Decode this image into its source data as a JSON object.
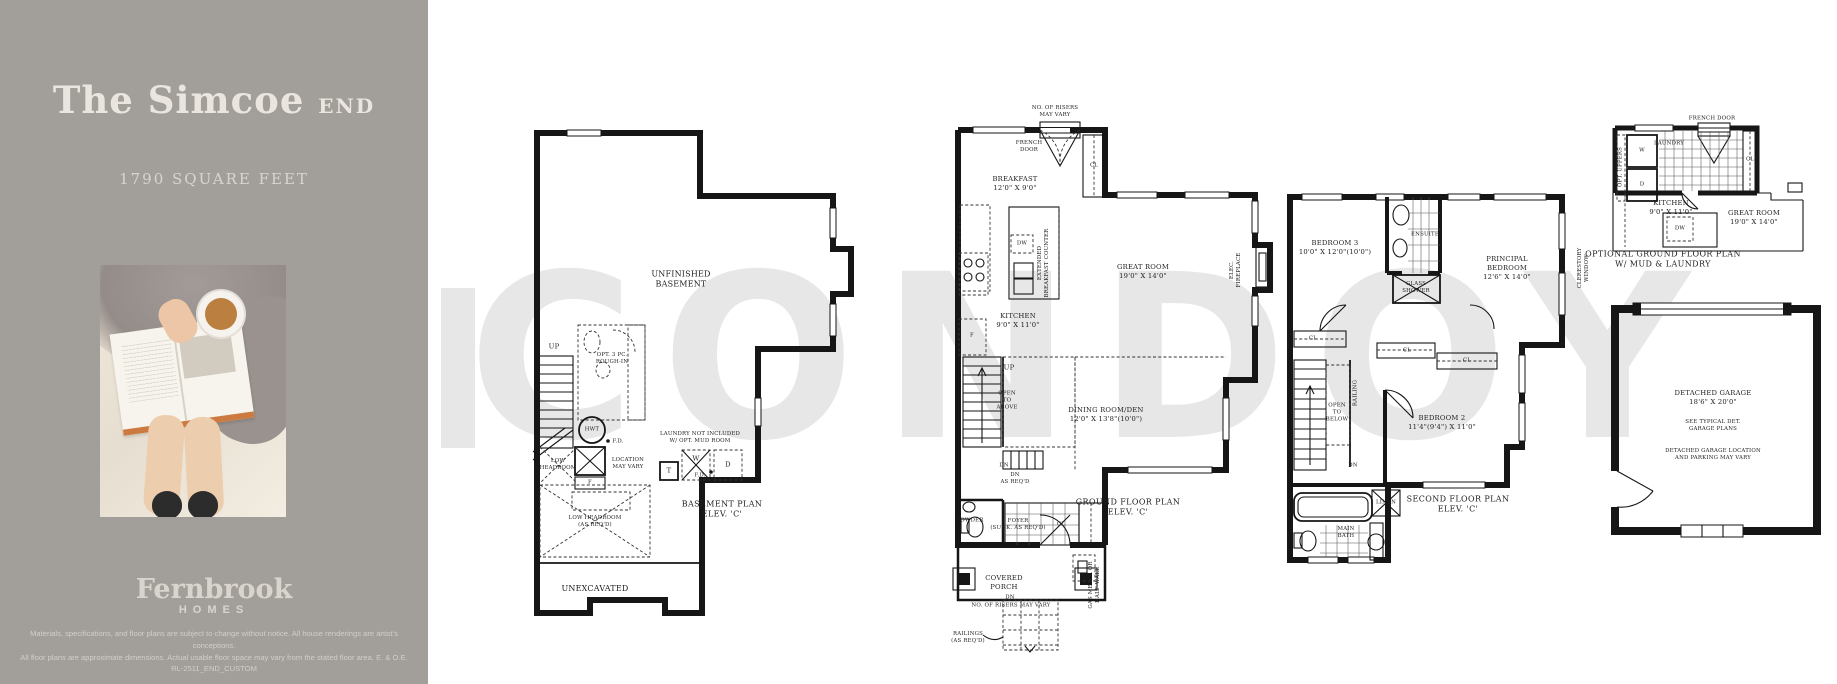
{
  "colors": {
    "sidebar_bg": "#a29e99",
    "sidebar_text": "#eae6df",
    "plan_line": "#161616",
    "watermark": "#e7e7e7"
  },
  "sidebar": {
    "title": "The Simcoe",
    "title_suffix": "END",
    "square_feet": "1790 SQUARE FEET",
    "logo_name": "Fernbrook",
    "logo_sub": "HOMES",
    "disclaimer_line1": "Materials, specifications, and floor plans are subject to change without notice. All house renderings are artist's conceptions.",
    "disclaimer_line2": "All floor plans are approximate dimensions. Actual usable floor space may vary from the stated floor area. E. & O.E. RL-2511_END_CUSTOM"
  },
  "watermark": "CONDOY",
  "basement": {
    "room": "UNFINISHED\nBASEMENT",
    "up": "UP",
    "opt_bath": "OPT. 3 PC.\nROUGH-IN",
    "hwt": "HWT",
    "fd1": "F.D.",
    "low_headroom": "LOW\nHEADROOM",
    "location": "LOCATION\nMAY VARY",
    "laundry_note": "LAUNDRY NOT INCLUDED\nW/ OPT. MUD ROOM",
    "tub": "T",
    "washer": "W",
    "dryer": "D",
    "fd2": "F.D.",
    "furnace": "F",
    "low_headroom2": "LOW HEADROOM\n(AS REQ'D)",
    "caption": "BASEMENT PLAN\nELEV. 'C'",
    "unexcavated": "UNEXCAVATED"
  },
  "ground": {
    "risers_top": "NO. OF RISERS\nMAY VARY",
    "french_door": "FRENCH\nDOOR",
    "breakfast": "BREAKFAST\n12'0\" X 9'0\"",
    "cl_top": "CL",
    "dw": "DW",
    "extended_counter": "EXTENDED\nBREAKFAST COUNTER",
    "great_room": "GREAT ROOM\n19'0\" X 14'0\"",
    "fireplace": "ELEC. FIREPLACE",
    "kitchen": "KITCHEN\n9'0\" X 11'0\"",
    "fridge": "F",
    "up": "UP",
    "open_above": "OPEN\nTO\nABOVE",
    "dining": "DINING ROOM/DEN\n12'0\" X 13'8\"(10'0\")",
    "dn": "DN",
    "dn_req": "DN\nAS REQ'D",
    "powder": "POWDER",
    "foyer": "FOYER\n(SUNK. AS REQ'D)",
    "cl_foyer": "CL",
    "caption": "GROUND FLOOR PLAN\nELEV. 'C'",
    "porch": "COVERED\nPORCH",
    "dn_porch": "DN",
    "risers_bottom": "NO. OF RISERS MAY VARY",
    "railings": "RAILINGS\n(AS REQ'D)",
    "gas_meter": "GAS METER OR\nHALF WALL"
  },
  "second": {
    "bedroom3": "BEDROOM 3\n10'0\" X 12'0\"(10'0\")",
    "ensuite": "ENSUITE",
    "glass_shower": "GLASS\nSHOWER",
    "principal": "PRINCIPAL\nBEDROOM\n12'6\" X 14'0\"",
    "cl1": "CL",
    "cl2": "CL",
    "cl3": "CL",
    "open_below": "OPEN\nTO\nBELOW",
    "railing": "RAILING",
    "dn": "DN",
    "bedroom2": "BEDROOM 2\n11'4\"(9'4\") X 11'0\"",
    "linen": "LINEN",
    "main_bath": "MAIN\nBATH",
    "caption": "SECOND FLOOR PLAN\nELEV. 'C'",
    "clerestory": "CLERESTORY WINDOW"
  },
  "optional": {
    "french_door": "FRENCH DOOR",
    "laundry": "LAUNDRY",
    "washer": "W",
    "dryer": "D",
    "opt_uppers": "OPT. UPPERS",
    "cl": "CL",
    "kitchen": "KITCHEN\n9'0\" X 11'0\"",
    "great_room": "GREAT ROOM\n19'0\" X 14'0\"",
    "dw": "DW",
    "caption": "OPTIONAL GROUND FLOOR PLAN\nW/ MUD & LAUNDRY"
  },
  "garage": {
    "title": "DETACHED GARAGE\n18'6\" X 20'0\"",
    "note1": "SEE TYPICAL DET.\nGARAGE PLANS",
    "note2": "DETACHED GARAGE LOCATION\nAND PARKING MAY VARY"
  }
}
